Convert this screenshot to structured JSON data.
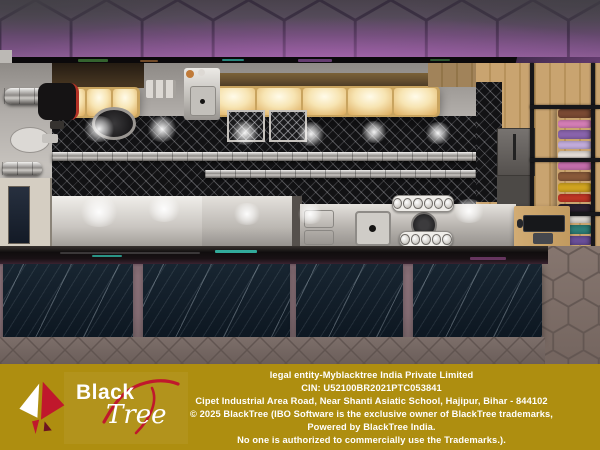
{
  "footer": {
    "logo": {
      "brand_first": "Black",
      "brand_second": "Tree"
    },
    "lines": [
      "legal entity-Myblacktree India Private Limited",
      "CIN: U52100BR2021PTC053841",
      "Cipet Industrial Area Road, Near Shanti Asiatic School, Hajipur, Bihar - 844102",
      "© 2025 BlackTree (IBO Software is the exclusive owner of BlackTree trademarks,",
      "Powered by BlackTree India.",
      "No one is authorized to commercially use the Trademarks.)."
    ]
  },
  "colors": {
    "footer-gold": "#ae8e10",
    "logo-red": "#c0182c",
    "wall-purple": "#6b4a6e",
    "floor-taupe": "#776965",
    "marble-navy": "#13202b",
    "steel-gray": "#c6c2bd",
    "wood-tan": "#c8a46e",
    "warm-light": "#f2dfae"
  }
}
